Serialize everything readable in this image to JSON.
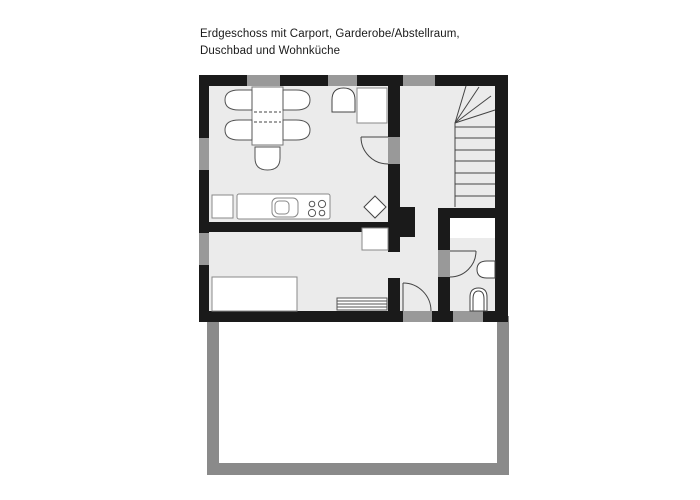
{
  "title": {
    "line1": "Erdgeschoss mit Carport, Garderobe/Abstellraum,",
    "line2": "Duschbad und Wohnküche"
  },
  "colors": {
    "wall": "#1a1a1a",
    "window_opening": "#999999",
    "floor": "#ebebeb",
    "carport_wall": "#8a8a8a",
    "paper": "#ffffff",
    "thin_line": "#444444",
    "furniture_stroke": "#888888"
  },
  "canvas": {
    "width": 700,
    "height": 500
  },
  "plan": {
    "shapes": [
      {
        "n": "house-floor",
        "t": "rect",
        "x": 199,
        "y": 75,
        "w": 309,
        "h": 247,
        "f": "#ebebeb"
      },
      {
        "n": "carport-wall",
        "t": "rect",
        "x": 207,
        "y": 316,
        "w": 302,
        "h": 159,
        "f": "#8a8a8a"
      },
      {
        "n": "carport-floor",
        "t": "rect",
        "x": 219,
        "y": 316,
        "w": 278,
        "h": 147,
        "f": "#ffffff"
      },
      {
        "n": "wall-top",
        "t": "rect",
        "x": 199,
        "y": 75,
        "w": 309,
        "h": 11,
        "f": "#1a1a1a"
      },
      {
        "n": "wall-left",
        "t": "rect",
        "x": 199,
        "y": 75,
        "w": 10,
        "h": 247,
        "f": "#1a1a1a"
      },
      {
        "n": "wall-right",
        "t": "rect",
        "x": 495,
        "y": 75,
        "w": 13,
        "h": 247,
        "f": "#1a1a1a"
      },
      {
        "n": "wall-bottom",
        "t": "rect",
        "x": 199,
        "y": 311,
        "w": 309,
        "h": 11,
        "f": "#1a1a1a"
      },
      {
        "n": "wall-partition-upper",
        "t": "rect",
        "x": 388,
        "y": 86,
        "w": 12,
        "h": 166,
        "f": "#1a1a1a"
      },
      {
        "n": "wall-partition-lower",
        "t": "rect",
        "x": 388,
        "y": 278,
        "w": 12,
        "h": 33,
        "f": "#1a1a1a"
      },
      {
        "n": "wall-living-divider",
        "t": "rect",
        "x": 205,
        "y": 222,
        "w": 195,
        "h": 10,
        "f": "#1a1a1a"
      },
      {
        "n": "chimney-block",
        "t": "rect",
        "x": 400,
        "y": 207,
        "w": 15,
        "h": 30,
        "f": "#1a1a1a"
      },
      {
        "n": "wall-bath-left",
        "t": "rect",
        "x": 438,
        "y": 208,
        "w": 12,
        "h": 103,
        "f": "#1a1a1a"
      },
      {
        "n": "wall-bath-top",
        "t": "rect",
        "x": 438,
        "y": 208,
        "w": 59,
        "h": 10,
        "f": "#1a1a1a"
      },
      {
        "n": "window-top-1",
        "t": "rect",
        "x": 247,
        "y": 75,
        "w": 33,
        "h": 11,
        "f": "#999999"
      },
      {
        "n": "window-top-2",
        "t": "rect",
        "x": 328,
        "y": 75,
        "w": 29,
        "h": 11,
        "f": "#999999"
      },
      {
        "n": "window-top-3",
        "t": "rect",
        "x": 403,
        "y": 75,
        "w": 32,
        "h": 11,
        "f": "#999999"
      },
      {
        "n": "window-left-1",
        "t": "rect",
        "x": 199,
        "y": 138,
        "w": 10,
        "h": 32,
        "f": "#999999"
      },
      {
        "n": "window-left-2",
        "t": "rect",
        "x": 199,
        "y": 233,
        "w": 10,
        "h": 32,
        "f": "#999999"
      },
      {
        "n": "entry-door-threshold",
        "t": "rect",
        "x": 403,
        "y": 311,
        "w": 29,
        "h": 11,
        "f": "#999999"
      },
      {
        "n": "window-bottom-bath",
        "t": "rect",
        "x": 453,
        "y": 311,
        "w": 30,
        "h": 11,
        "f": "#999999"
      },
      {
        "n": "kitchen-door-opening",
        "t": "rect",
        "x": 388,
        "y": 137,
        "w": 12,
        "h": 27,
        "f": "#999999"
      },
      {
        "n": "bath-door-opening",
        "t": "rect",
        "x": 438,
        "y": 250,
        "w": 12,
        "h": 27,
        "f": "#999999"
      },
      {
        "n": "shower-area",
        "t": "rect",
        "x": 450,
        "y": 218,
        "w": 45,
        "h": 20,
        "f": "#ffffff"
      },
      {
        "n": "stair-left-edge",
        "t": "line",
        "x1": 455,
        "y1": 123,
        "x2": 455,
        "y2": 207,
        "s": "#444444"
      },
      {
        "n": "stair-tread",
        "t": "line",
        "x1": 455,
        "y1": 127,
        "x2": 495,
        "y2": 127,
        "s": "#444444"
      },
      {
        "n": "stair-tread",
        "t": "line",
        "x1": 455,
        "y1": 138,
        "x2": 495,
        "y2": 138,
        "s": "#444444"
      },
      {
        "n": "stair-tread",
        "t": "line",
        "x1": 455,
        "y1": 150,
        "x2": 495,
        "y2": 150,
        "s": "#444444"
      },
      {
        "n": "stair-tread",
        "t": "line",
        "x1": 455,
        "y1": 161,
        "x2": 495,
        "y2": 161,
        "s": "#444444"
      },
      {
        "n": "stair-tread",
        "t": "line",
        "x1": 455,
        "y1": 173,
        "x2": 495,
        "y2": 173,
        "s": "#444444"
      },
      {
        "n": "stair-tread",
        "t": "line",
        "x1": 455,
        "y1": 184,
        "x2": 495,
        "y2": 184,
        "s": "#444444"
      },
      {
        "n": "stair-tread",
        "t": "line",
        "x1": 455,
        "y1": 196,
        "x2": 495,
        "y2": 196,
        "s": "#444444"
      },
      {
        "n": "stair-winder",
        "t": "line",
        "x1": 455,
        "y1": 123,
        "x2": 466,
        "y2": 86,
        "s": "#444444"
      },
      {
        "n": "stair-winder",
        "t": "line",
        "x1": 455,
        "y1": 123,
        "x2": 479,
        "y2": 87,
        "s": "#444444"
      },
      {
        "n": "stair-winder",
        "t": "line",
        "x1": 455,
        "y1": 123,
        "x2": 491,
        "y2": 96,
        "s": "#444444"
      },
      {
        "n": "stair-winder",
        "t": "line",
        "x1": 455,
        "y1": 123,
        "x2": 495,
        "y2": 110,
        "s": "#444444"
      },
      {
        "n": "dining-table",
        "t": "rect",
        "x": 252,
        "y": 87,
        "w": 31,
        "h": 58,
        "f": "#ffffff",
        "s": "#777777"
      },
      {
        "n": "table-extension-line",
        "t": "line",
        "x1": 254,
        "y1": 112,
        "x2": 281,
        "y2": 112,
        "s": "#444444",
        "dash": "3,2"
      },
      {
        "n": "table-extension-line",
        "t": "line",
        "x1": 254,
        "y1": 122,
        "x2": 281,
        "y2": 122,
        "s": "#444444",
        "dash": "3,2"
      },
      {
        "n": "chair",
        "t": "path",
        "d": "M252,90 L239,90 Q225,90 225,100 Q225,110 239,110 L252,110 Z",
        "f": "#ffffff",
        "s": "#555555"
      },
      {
        "n": "chair",
        "t": "path",
        "d": "M252,120 L239,120 Q225,120 225,130 Q225,140 239,140 L252,140 Z",
        "f": "#ffffff",
        "s": "#555555"
      },
      {
        "n": "chair",
        "t": "path",
        "d": "M283,90 L296,90 Q310,90 310,100 Q310,110 296,110 L283,110 Z",
        "f": "#ffffff",
        "s": "#555555"
      },
      {
        "n": "chair",
        "t": "path",
        "d": "M283,120 L296,120 Q310,120 310,130 Q310,140 296,140 L283,140 Z",
        "f": "#ffffff",
        "s": "#555555"
      },
      {
        "n": "chair",
        "t": "path",
        "d": "M255,147 L255,158 Q255,170 267.5,170 Q280,170 280,158 L280,147 Z",
        "f": "#ffffff",
        "s": "#555555"
      },
      {
        "n": "wash-basin-unit",
        "t": "path",
        "d": "M332,112 L332,100 Q332,88 343.5,88 Q355,88 355,100 L355,112 Z",
        "f": "#ffffff",
        "s": "#444444"
      },
      {
        "n": "appliance-box",
        "t": "rect",
        "x": 357,
        "y": 88,
        "w": 30,
        "h": 35,
        "f": "#ffffff",
        "s": "#888888"
      },
      {
        "n": "kitchen-cabinet",
        "t": "rect",
        "x": 212,
        "y": 195,
        "w": 21,
        "h": 23,
        "f": "#ffffff",
        "s": "#888888"
      },
      {
        "n": "kitchen-counter",
        "t": "rect",
        "x": 237,
        "y": 194,
        "w": 93,
        "h": 25,
        "rx": 2,
        "f": "#ffffff",
        "s": "#888888"
      },
      {
        "n": "sink-outer",
        "t": "rect",
        "x": 272,
        "y": 198,
        "w": 26,
        "h": 19,
        "rx": 5,
        "f": "none",
        "s": "#888888"
      },
      {
        "n": "sink-basin",
        "t": "rect",
        "x": 275,
        "y": 201,
        "w": 14,
        "h": 13,
        "rx": 4,
        "f": "none",
        "s": "#888888"
      },
      {
        "n": "hob-burner",
        "t": "circle",
        "cx": 312,
        "cy": 204,
        "r": 2.8,
        "f": "none",
        "s": "#555555"
      },
      {
        "n": "hob-burner",
        "t": "circle",
        "cx": 322,
        "cy": 204,
        "r": 3.6,
        "f": "none",
        "s": "#555555"
      },
      {
        "n": "hob-burner",
        "t": "circle",
        "cx": 312,
        "cy": 213,
        "r": 3.6,
        "f": "none",
        "s": "#555555"
      },
      {
        "n": "hob-burner",
        "t": "circle",
        "cx": 322,
        "cy": 213,
        "r": 2.8,
        "f": "none",
        "s": "#555555"
      },
      {
        "n": "floor-drain",
        "t": "path",
        "d": "M375,196 L386,207 L375,218 L364,207 Z",
        "f": "#ffffff",
        "s": "#444444"
      },
      {
        "n": "cabinet-box",
        "t": "rect",
        "x": 362,
        "y": 228,
        "w": 26,
        "h": 22,
        "f": "#ffffff",
        "s": "#888888"
      },
      {
        "n": "couch",
        "t": "rect",
        "x": 212,
        "y": 277,
        "w": 85,
        "h": 34,
        "f": "#ffffff",
        "s": "#888888"
      },
      {
        "n": "radiator",
        "t": "rect",
        "x": 337,
        "y": 298,
        "w": 50,
        "h": 12,
        "f": "#ffffff",
        "s": "#555555"
      },
      {
        "n": "radiator-fin-line",
        "t": "line",
        "x1": 337,
        "y1": 301,
        "x2": 387,
        "y2": 301,
        "s": "#555555"
      },
      {
        "n": "radiator-fin-line",
        "t": "line",
        "x1": 337,
        "y1": 304,
        "x2": 387,
        "y2": 304,
        "s": "#555555"
      },
      {
        "n": "radiator-fin-line",
        "t": "line",
        "x1": 337,
        "y1": 307,
        "x2": 387,
        "y2": 307,
        "s": "#555555"
      },
      {
        "n": "kitchen-door-leaf",
        "t": "line",
        "x1": 388,
        "y1": 137,
        "x2": 361,
        "y2": 137,
        "s": "#444444"
      },
      {
        "n": "kitchen-door-swing",
        "t": "path",
        "d": "M361,137 A27,27 0 0 0 388,164",
        "f": "none",
        "s": "#444444"
      },
      {
        "n": "entry-door-leaf",
        "t": "line",
        "x1": 403,
        "y1": 283,
        "x2": 403,
        "y2": 311,
        "s": "#444444"
      },
      {
        "n": "entry-door-swing",
        "t": "path",
        "d": "M403,283 A28,28 0 0 1 431,311",
        "f": "none",
        "s": "#444444"
      },
      {
        "n": "bath-door-leaf",
        "t": "line",
        "x1": 450,
        "y1": 251,
        "x2": 476,
        "y2": 251,
        "s": "#444444"
      },
      {
        "n": "bath-door-swing",
        "t": "path",
        "d": "M476,251 A26,26 0 0 1 450,277",
        "f": "none",
        "s": "#444444"
      },
      {
        "n": "washbasin",
        "t": "path",
        "d": "M495,261 L487,261 Q477,261 477,269.5 Q477,278 487,278 L495,278 Z",
        "f": "#ffffff",
        "s": "#444444"
      },
      {
        "n": "toilet-bowl",
        "t": "path",
        "d": "M470,311 L470,297 Q470,288 478.5,288 Q487,288 487,297 L487,311 Z",
        "f": "#ffffff",
        "s": "#444444"
      },
      {
        "n": "toilet-rim",
        "t": "path",
        "d": "M473,311 L473,299 Q473,291 478.5,291 Q484,291 484,299 L484,311 Z",
        "f": "none",
        "s": "#444444"
      }
    ]
  }
}
